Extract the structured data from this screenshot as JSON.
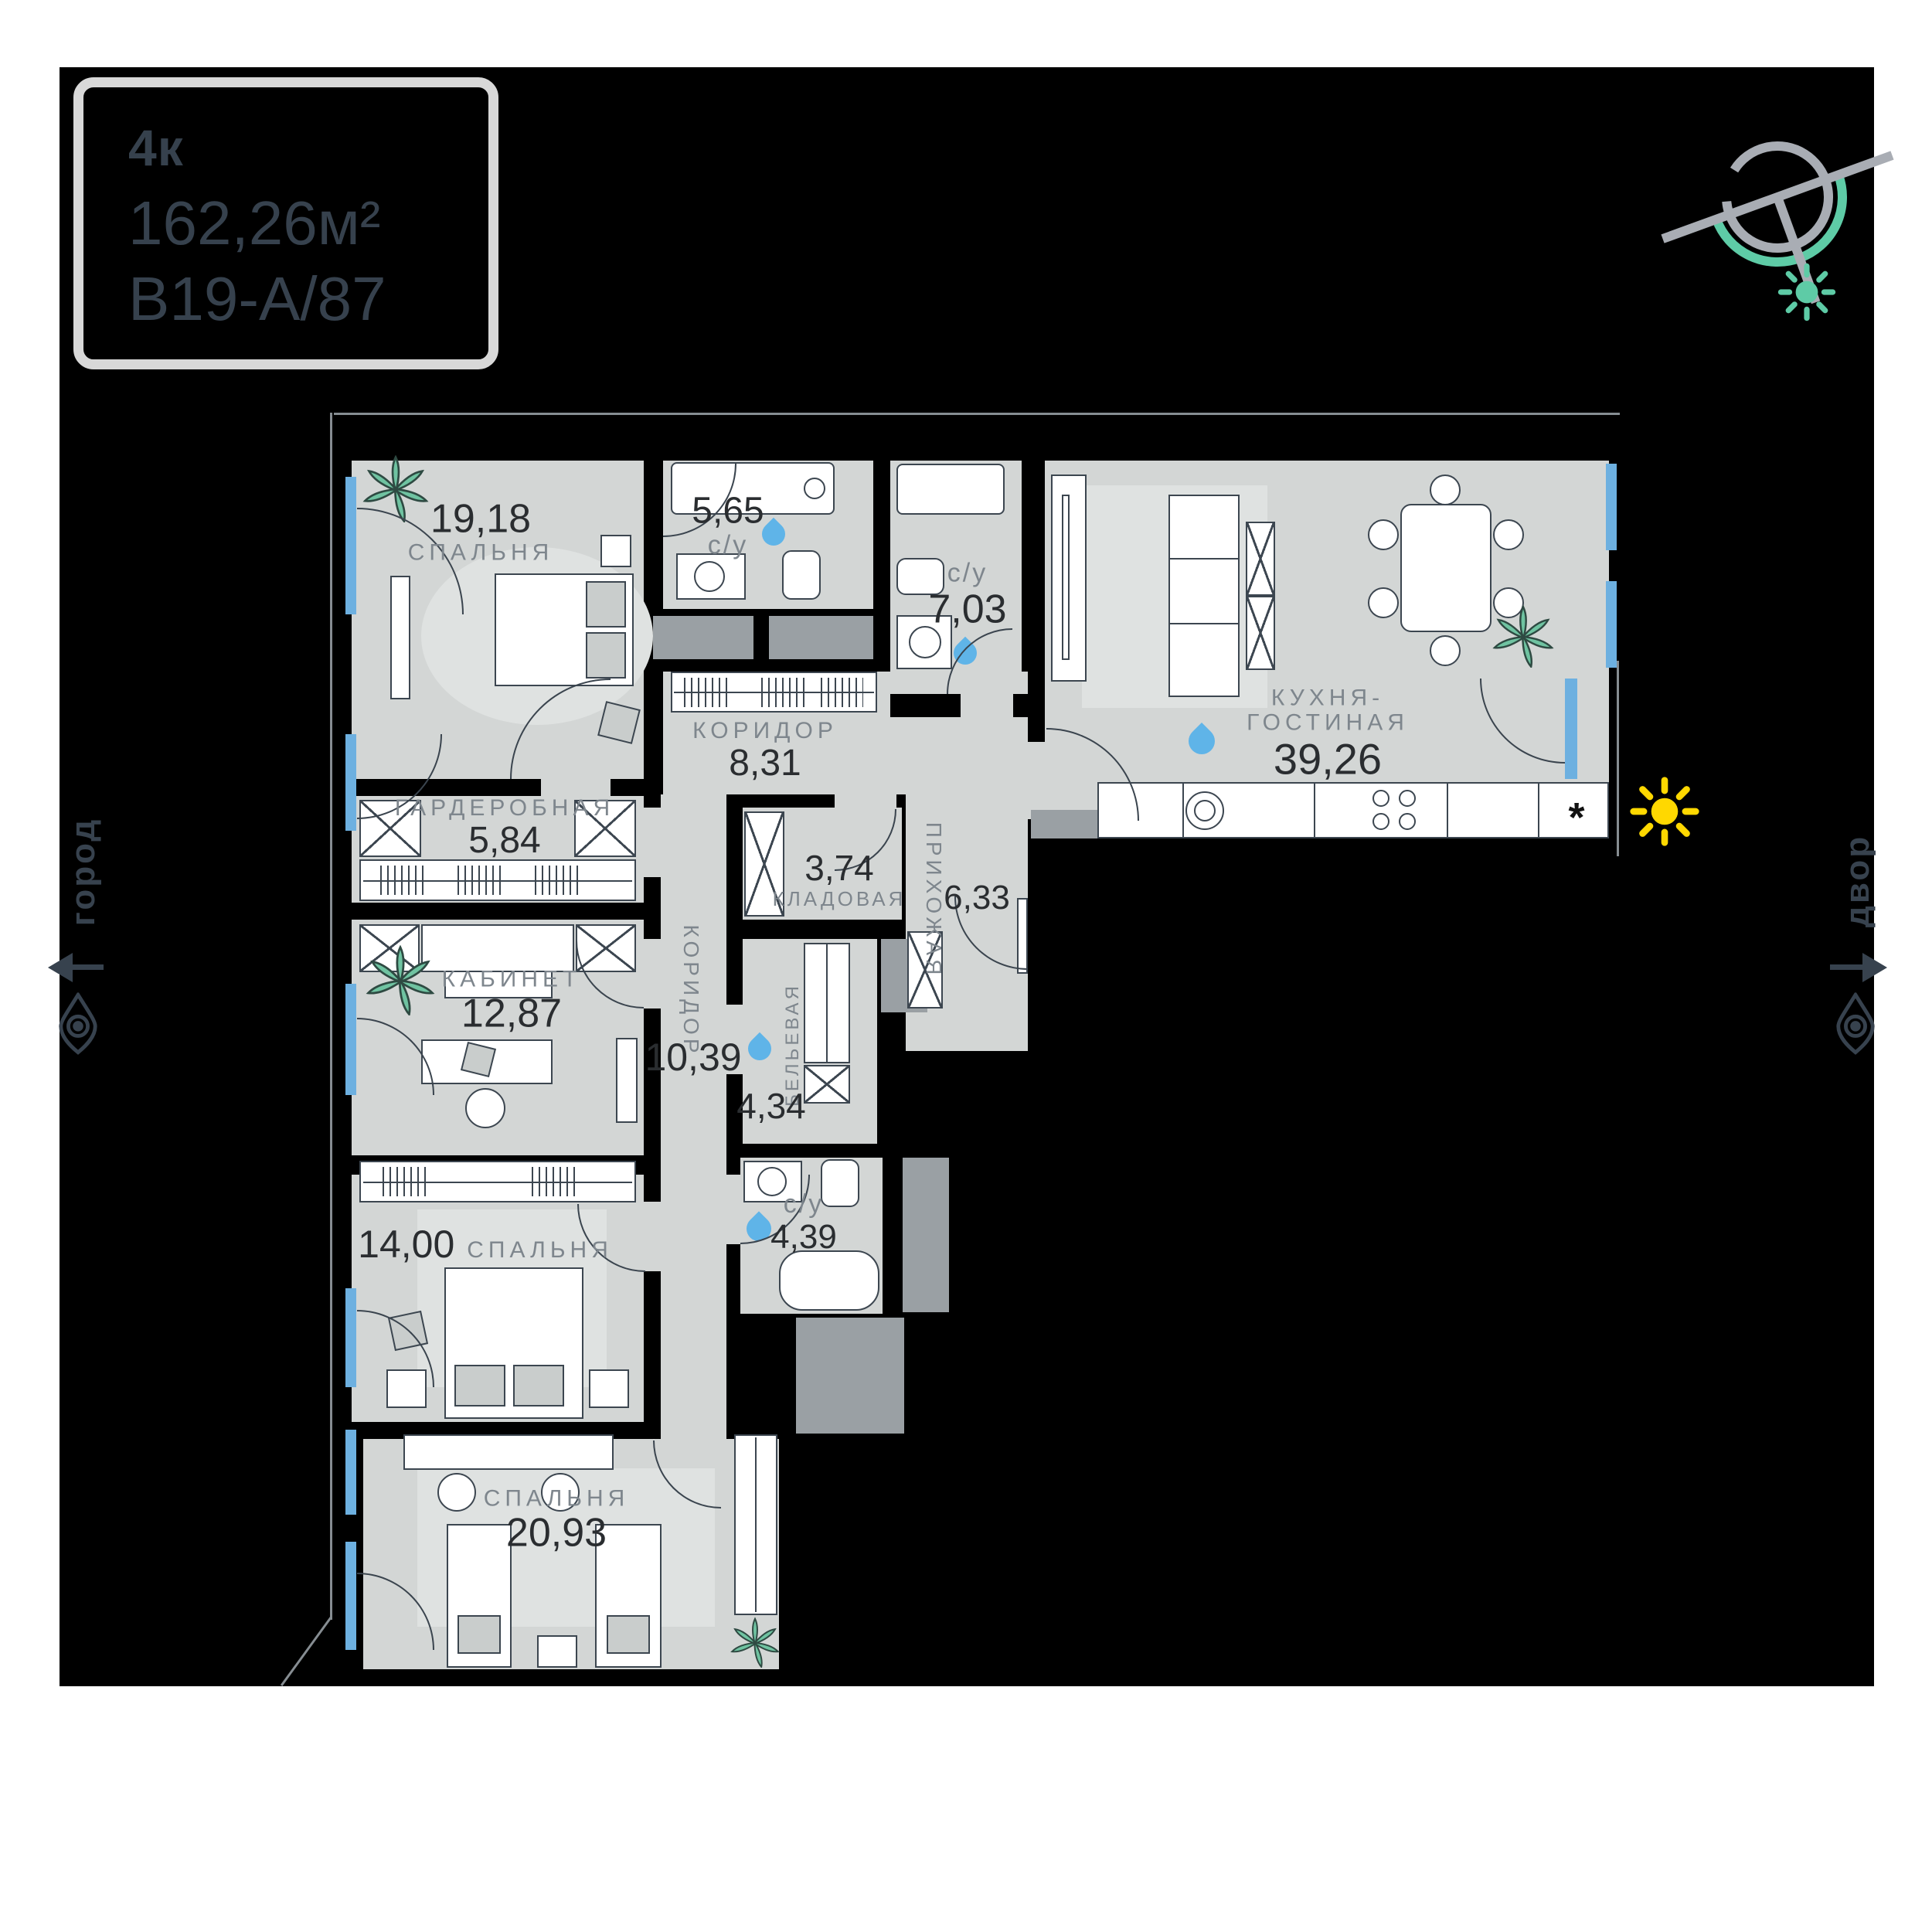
{
  "unit_card": {
    "rooms_label": "4к",
    "area": "162,26м²",
    "code": "B19-А/87"
  },
  "orientation": {
    "left_label": "город",
    "right_label": "двор"
  },
  "rooms": [
    {
      "id": "bedroom-1",
      "name": "СПАЛЬНЯ",
      "area": "19,18"
    },
    {
      "id": "bathroom-1",
      "name": "с/у",
      "area": "5,65"
    },
    {
      "id": "bathroom-2",
      "name": "с/у",
      "area": "7,03"
    },
    {
      "id": "kitchen-living",
      "name_line1": "КУХНЯ-",
      "name_line2": "ГОСТИНАЯ",
      "area": "39,26"
    },
    {
      "id": "corridor-1",
      "name": "КОРИДОР",
      "area": "8,31"
    },
    {
      "id": "wardrobe-room",
      "name": "ГАРДЕРОБНАЯ",
      "area": "5,84"
    },
    {
      "id": "storage",
      "name": "КЛАДОВАЯ",
      "area": "3,74"
    },
    {
      "id": "hallway",
      "name": "ПРИХОЖАЯ",
      "area": "6,33"
    },
    {
      "id": "office",
      "name": "КАБИНЕТ",
      "area": "12,87"
    },
    {
      "id": "corridor-2",
      "name": "КОРИДОР",
      "area": "10,39"
    },
    {
      "id": "linen-room",
      "name": "БЕЛЬЕВАЯ",
      "area": "4,34"
    },
    {
      "id": "bedroom-2",
      "name": "СПАЛЬНЯ",
      "area": "14,00"
    },
    {
      "id": "bathroom-3",
      "name": "с/у",
      "area": "4,39"
    },
    {
      "id": "bedroom-3",
      "name": "СПАЛЬНЯ",
      "area": "20,93"
    }
  ],
  "symbols": {
    "fridge": "*"
  },
  "colors": {
    "page_bg": "#ffffff",
    "canvas_bg": "#000000",
    "floor": "#d3d6d5",
    "floor_light": "#dfe2e1",
    "shaft_gray": "#9aa0a4",
    "outline": "#3c4650",
    "room_name_gray": "#7e868d",
    "room_number": "#2a2d30",
    "window_blue": "#6db0e0",
    "water_drop_blue": "#5fb4e8",
    "plant_teal": "#6fc3a1",
    "sun_yellow": "#ffd800",
    "compass_gray": "#a9adb4",
    "compass_green": "#5ecba6",
    "annotation_slate": "#37424e",
    "card_border": "#d8d8d8"
  }
}
